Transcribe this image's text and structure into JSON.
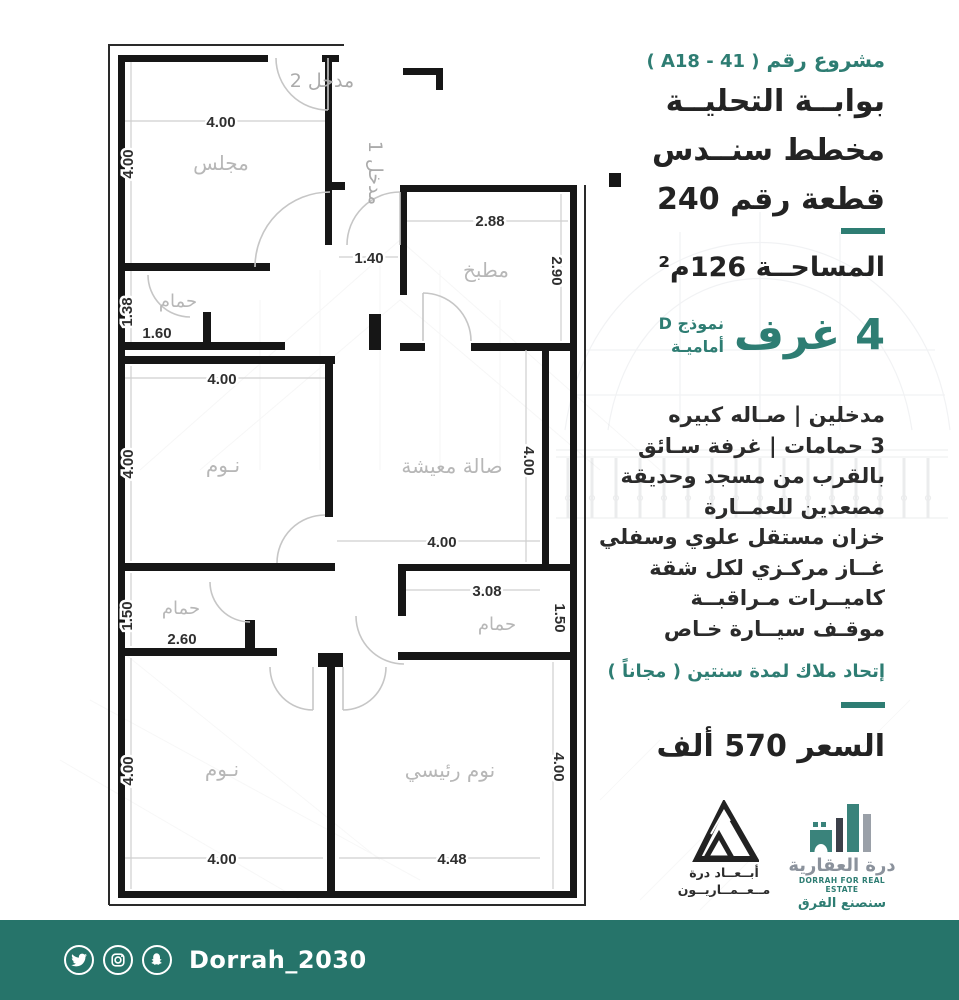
{
  "colors": {
    "accent": "#2e7d73",
    "footer_bar": "#26746a",
    "ink": "#262626",
    "room_label": "#b7b7b7",
    "wall": "#161616"
  },
  "panel": {
    "project_label": "مشروع رقم",
    "project_code": "( A18 - 41 )",
    "title_line1": "بوابــة التحليــة",
    "title_line2": "مخطط سنــدس",
    "title_line3": "قطعة رقم 240",
    "area_text": "المساحــة 126م²",
    "rooms_count": "4 غرف",
    "model_line1": "نموذج D",
    "model_line2": "أماميـة",
    "features": [
      "مدخلين  |  صـاله كبيره",
      "3 حمامات | غرفة سـائق",
      "بالقرب من مسجد وحديقة",
      "مصعدين  للعمــارة",
      "خزان مستقل علوي وسفلي",
      "غــاز مركـزي لكل شقة",
      "كاميــرات مـراقبــة",
      "موقـف سيــارة خـاص"
    ],
    "owners_union": "إتحاد ملاك لمدة سنتين ( مجاناً )",
    "price": "السعر  570  ألف"
  },
  "plan": {
    "labels": {
      "majlis": "مجلس",
      "bath": "حمام",
      "kitchen": "مطبخ",
      "bedroom": "نـوم",
      "living": "صالة معيشة",
      "master": "نوم رئيسي",
      "entrance1": "مدخل 1",
      "entrance2": "مدخل 2"
    },
    "dims": {
      "majlis_top": "4.00",
      "majlis_left": "4.00",
      "bath1_left": "1.38",
      "bath1_bottom": "1.60",
      "entry": "1.40",
      "kitchen_top": "2.88",
      "kitchen_right": "2.90",
      "bed1_top": "4.00",
      "bed1_left": "4.00",
      "living_bottom": "4.00",
      "living_right": "4.00",
      "bath2_left": "1.50",
      "bath2_bottom": "2.60",
      "bed2_left": "4.00",
      "bed2_bottom": "4.00",
      "mbath_top": "3.08",
      "mbath_right": "1.50",
      "master_right": "4.00",
      "master_bottom": "4.48"
    }
  },
  "logos": {
    "abaad": {
      "line1": "أبــعــاد درة",
      "line2": "مــعــمــاريــون"
    },
    "dorrah": {
      "name_ar": "درة العقارية",
      "name_en": "DORRAH FOR REAL ESTATE",
      "slogan": "سنصنع الفرق"
    }
  },
  "footer": {
    "handle": "Dorrah_2030"
  }
}
